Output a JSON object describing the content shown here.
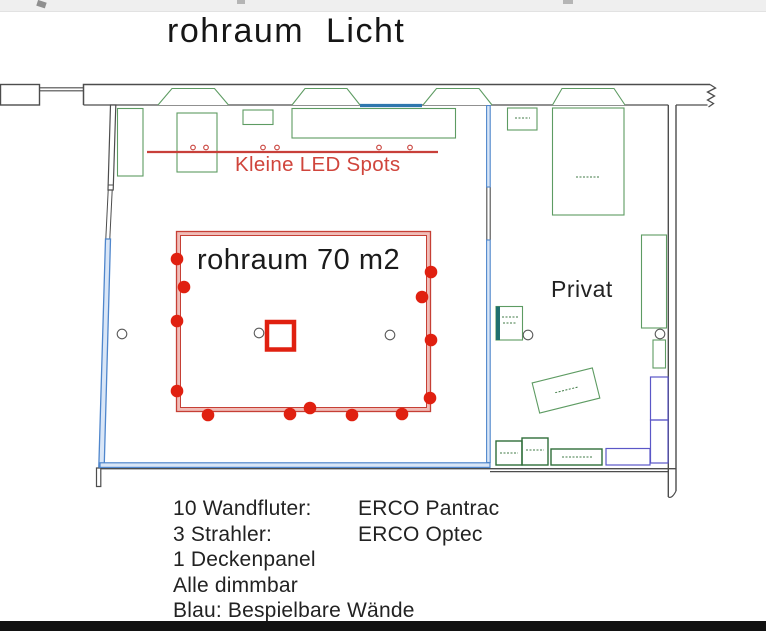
{
  "title": "rohraum  Licht",
  "plan": {
    "rohraum_label": "rohraum 70 m2",
    "privat_label": "Privat",
    "led_spots_label": "Kleine LED Spots"
  },
  "legend": {
    "lines": [
      {
        "item": "10 Wandfluter:",
        "product": "ERCO Pantrac"
      },
      {
        "item": "3 Strahler:",
        "product": "ERCO Optec"
      },
      {
        "item": "1 Deckenpanel",
        "product": ""
      },
      {
        "item": "Alle dimmbar",
        "product": ""
      },
      {
        "item": "Blau: Bespielbare Wände",
        "product": ""
      }
    ]
  },
  "colors": {
    "wall": "#4d4d4d",
    "furniture_green": "#5d9b62",
    "blue_wall": "#4f86cc",
    "blue_wall_fill": "#d9e6f7",
    "teal_wall_segment": "#2e77ae",
    "stairs_purple": "#5b57c7",
    "red_line": "#c8403a",
    "red_fixture": "#e02010"
  },
  "fixtures": {
    "wandfluter_dots": [
      [
        177,
        259
      ],
      [
        177,
        321
      ],
      [
        177,
        391
      ],
      [
        431,
        272
      ],
      [
        431,
        340
      ],
      [
        430,
        398
      ],
      [
        208,
        415
      ],
      [
        290,
        414
      ],
      [
        352,
        415
      ],
      [
        402,
        414
      ]
    ],
    "strahler_dots": [
      [
        184,
        287
      ],
      [
        422,
        297
      ],
      [
        310,
        408
      ]
    ],
    "deckenpanel": {
      "x": 267,
      "y": 322,
      "w": 27,
      "h": 27.5
    },
    "led_marker_xs": [
      193,
      206,
      263,
      277,
      379,
      410
    ],
    "led_marker_y": 147.5,
    "columns": [
      [
        122,
        334
      ],
      [
        259,
        333
      ],
      [
        390,
        335
      ],
      [
        528,
        335
      ],
      [
        660,
        334
      ]
    ]
  }
}
